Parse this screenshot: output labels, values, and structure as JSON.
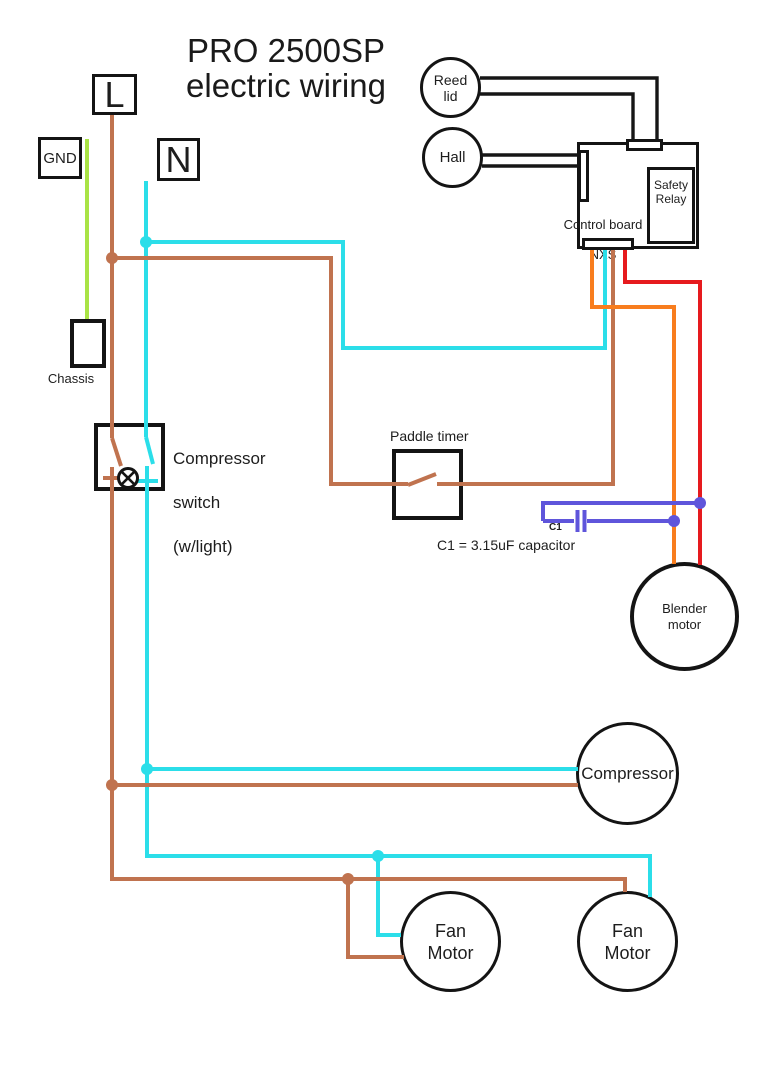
{
  "title": {
    "line1": "PRO 2500SP",
    "line2": "electric wiring"
  },
  "terminals": {
    "live": "L",
    "neutral": "N",
    "ground": "GND"
  },
  "chassis": {
    "label": "Chassis"
  },
  "sensors": {
    "reed_lid": "Reed lid",
    "hall": "Hall"
  },
  "control_board": {
    "name_line1": "Control board",
    "name_line2": "NXS",
    "safety_relay": "Safety Relay"
  },
  "switches": {
    "compressor_switch_line1": "Compressor",
    "compressor_switch_line2": "switch",
    "compressor_switch_line3": "(w/light)",
    "paddle_timer": "Paddle timer"
  },
  "capacitor": {
    "designator": "C1",
    "caption": "C1 = 3.15uF capacitor"
  },
  "motors": {
    "blender": "Blender motor",
    "compressor": "Compressor",
    "fan_left": "Fan Motor",
    "fan_right": "Fan Motor"
  },
  "wire_colors": {
    "live": "#c0734f",
    "neutral": "#2bdee9",
    "ground": "#a9e345",
    "orange": "#f87d1e",
    "red": "#e61a1e",
    "capacitor": "#5f55db",
    "signal": "#161616"
  }
}
